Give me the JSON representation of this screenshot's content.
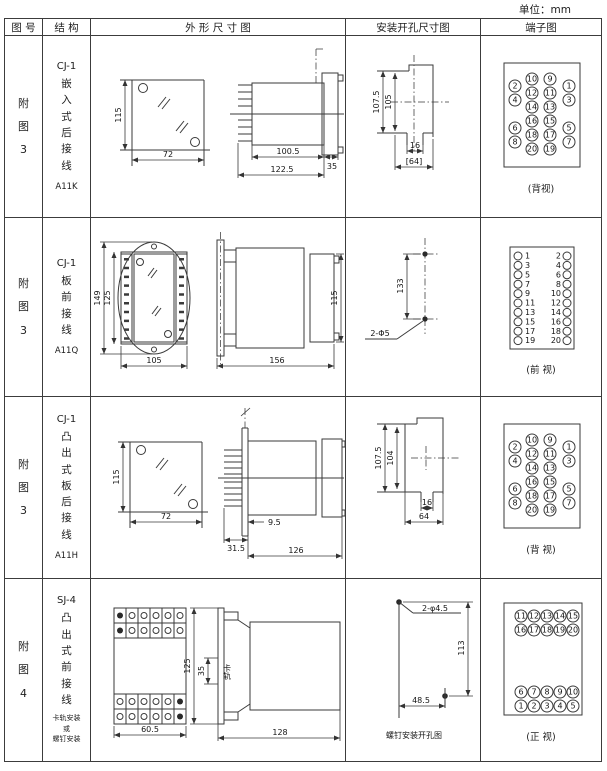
{
  "page": {
    "unit_label": "单位：mm"
  },
  "table": {
    "headers": [
      "图 号",
      "结 构",
      "外 形 尺 寸 图",
      "安装开孔尺寸图",
      "端子图"
    ]
  },
  "rows": [
    {
      "fig_no": "附图3",
      "model": "CJ-1",
      "structure_name": "嵌入式后接线",
      "code": "A11K",
      "outline": {
        "front_height": "115",
        "front_width": "72",
        "body_depth": "100.5",
        "total_depth": "122.5",
        "flange_depth": "35"
      },
      "install": {
        "height_outer": "107.5",
        "height_inner": "105",
        "notch_width": "16",
        "cutout_width": "[64]"
      },
      "terminals": {
        "view_label": "(背视)",
        "mid_left": [
          "10",
          "12",
          "14",
          "16",
          "18",
          "20"
        ],
        "mid_right": [
          "9",
          "11",
          "13",
          "15",
          "17",
          "19"
        ],
        "outer_left": [
          "2",
          "4",
          "6",
          "8"
        ],
        "outer_right": [
          "1",
          "3",
          "5",
          "7"
        ]
      }
    },
    {
      "fig_no": "附图3",
      "model": "CJ-1",
      "structure_name": "板前接线",
      "code": "A11Q",
      "outline": {
        "plate_height": "149",
        "body_height": "125",
        "body_width": "105",
        "side_length": "156",
        "side_height": "115"
      },
      "install": {
        "hole_spacing": "133",
        "hole_spec": "2-Φ5"
      },
      "terminals": {
        "view_label": "(前 视)",
        "left": [
          "1",
          "3",
          "5",
          "7",
          "9",
          "11",
          "13",
          "15",
          "17",
          "19"
        ],
        "right": [
          "2",
          "4",
          "6",
          "8",
          "10",
          "12",
          "14",
          "16",
          "18",
          "20"
        ]
      }
    },
    {
      "fig_no": "附图3",
      "model": "CJ-1",
      "structure_name": "凸出式板后接线",
      "code": "A11H",
      "outline": {
        "front_height": "115",
        "front_width": "72",
        "pin_depth": "31.5",
        "panel_offset": "9.5",
        "body_length": "126"
      },
      "install": {
        "height_outer": "107.5",
        "height_inner": "104",
        "notch_width": "16",
        "cutout_width": "64"
      },
      "terminals": {
        "view_label": "(背 视)",
        "mid_left": [
          "10",
          "12",
          "14",
          "16",
          "18",
          "20"
        ],
        "mid_right": [
          "9",
          "11",
          "13",
          "15",
          "17",
          "19"
        ],
        "outer_left": [
          "2",
          "4",
          "6",
          "8"
        ],
        "outer_right": [
          "1",
          "3",
          "5",
          "7"
        ]
      }
    },
    {
      "fig_no": "附图4",
      "model": "SJ-4",
      "structure_name": "凸出式前接线",
      "mount_note": [
        "卡轨安装",
        "或",
        "螺钉安装"
      ],
      "outline": {
        "front_width": "60.5",
        "side_height": "125",
        "rail_height": "35",
        "rail_label": "卡轨",
        "side_length": "128"
      },
      "install": {
        "hole_spec": "2-φ4.5",
        "v_spacing": "113",
        "h_spacing": "48.5",
        "caption": "螺钉安装开孔图"
      },
      "terminals": {
        "view_label": "(正 视)",
        "top_rows": [
          [
            "11",
            "12",
            "13",
            "14",
            "15"
          ],
          [
            "16",
            "17",
            "18",
            "19",
            "20"
          ]
        ],
        "bottom_rows": [
          [
            "6",
            "7",
            "8",
            "9",
            "10"
          ],
          [
            "1",
            "2",
            "3",
            "4",
            "5"
          ]
        ]
      }
    }
  ]
}
